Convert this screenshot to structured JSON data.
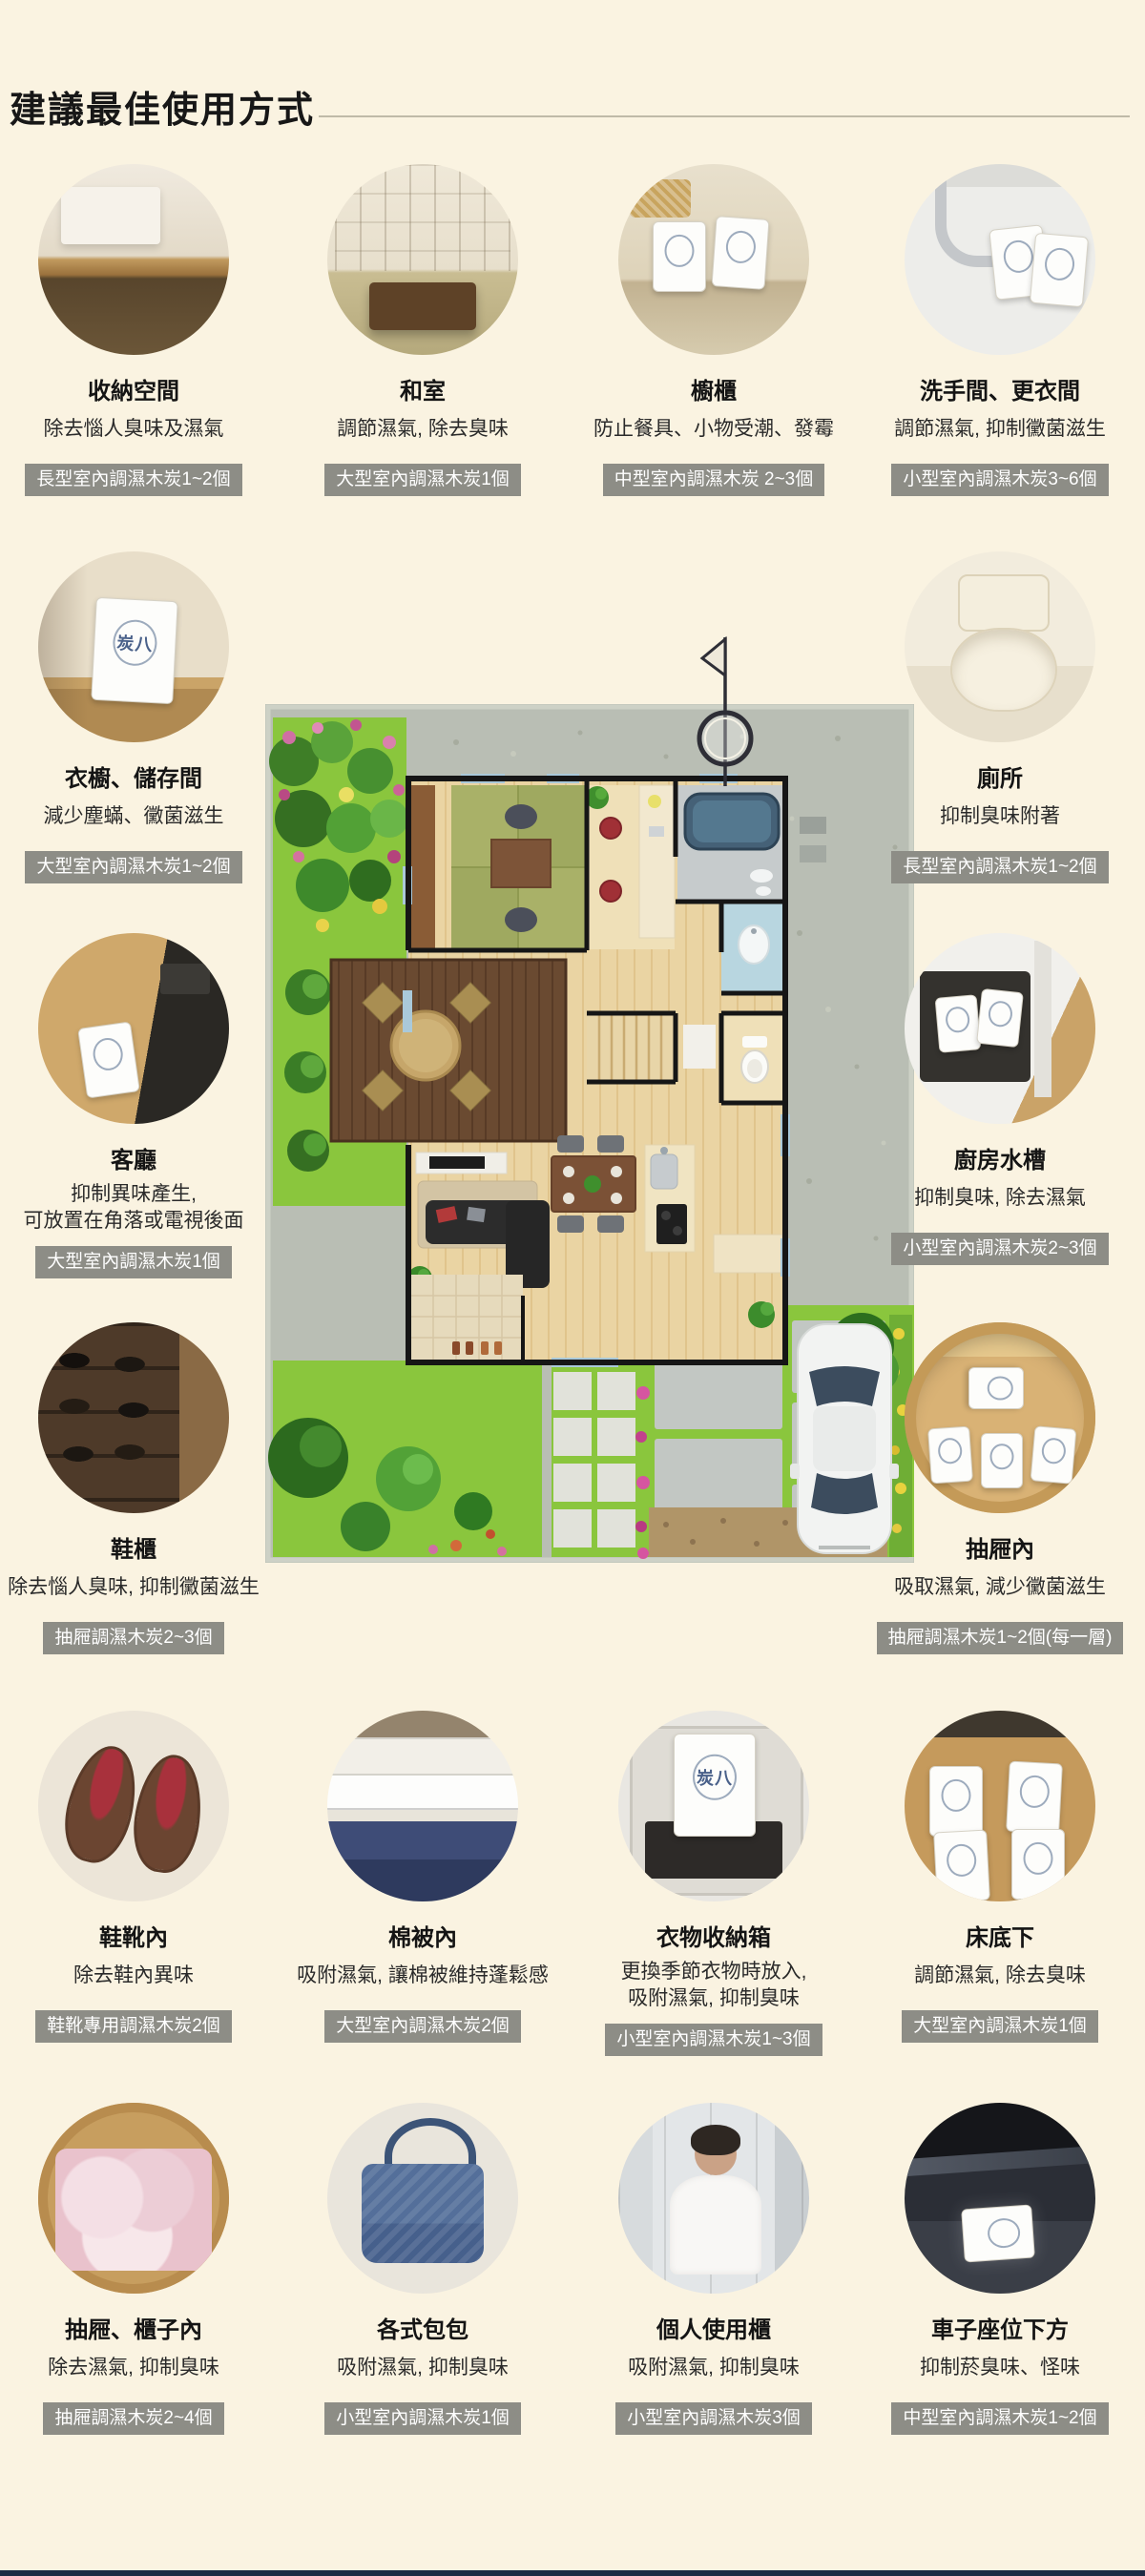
{
  "theme": {
    "background": "#faf3e1",
    "badge_bg": "#8d8d86",
    "badge_text": "#ffffff",
    "bottom_bar": "#1d2944"
  },
  "header": {
    "title": "建議最佳使用方式"
  },
  "bag_label": "炭八",
  "items": [
    {
      "title": "收納空間",
      "desc": "除去惱人臭味及濕氣",
      "badge": "長型室內調濕木炭1~2個"
    },
    {
      "title": "和室",
      "desc": "調節濕氣, 除去臭味",
      "badge": "大型室內調濕木炭1個"
    },
    {
      "title": "櫥櫃",
      "desc": "防止餐具、小物受潮、發霉",
      "badge": "中型室內調濕木炭 2~3個"
    },
    {
      "title": "洗手間、更衣間",
      "desc": "調節濕氣, 抑制黴菌滋生",
      "badge": "小型室內調濕木炭3~6個"
    },
    {
      "title": "衣櫥、儲存間",
      "desc": "減少塵蟎、黴菌滋生",
      "badge": "大型室內調濕木炭1~2個"
    },
    {
      "title": "廁所",
      "desc": "抑制臭味附著",
      "badge": "長型室內調濕木炭1~2個"
    },
    {
      "title": "客廳",
      "desc": "抑制異味產生,\n可放置在角落或電視後面",
      "badge": "大型室內調濕木炭1個"
    },
    {
      "title": "廚房水槽",
      "desc": "抑制臭味, 除去濕氣",
      "badge": "小型室內調濕木炭2~3個"
    },
    {
      "title": "鞋櫃",
      "desc": "除去惱人臭味, 抑制黴菌滋生",
      "badge": "抽屜調濕木炭2~3個"
    },
    {
      "title": "抽屜內",
      "desc": "吸取濕氣, 減少黴菌滋生",
      "badge": "抽屜調濕木炭1~2個(每一層)"
    },
    {
      "title": "鞋靴內",
      "desc": "除去鞋內異味",
      "badge": "鞋靴專用調濕木炭2個"
    },
    {
      "title": "棉被內",
      "desc": "吸附濕氣, 讓棉被維持蓬鬆感",
      "badge": "大型室內調濕木炭2個"
    },
    {
      "title": "衣物收納箱",
      "desc": "更換季節衣物時放入,\n吸附濕氣, 抑制臭味",
      "badge": "小型室內調濕木炭1~3個"
    },
    {
      "title": "床底下",
      "desc": "調節濕氣, 除去臭味",
      "badge": "大型室內調濕木炭1個"
    },
    {
      "title": "抽屜、櫃子內",
      "desc": "除去濕氣, 抑制臭味",
      "badge": "抽屜調濕木炭2~4個"
    },
    {
      "title": "各式包包",
      "desc": "吸附濕氣, 抑制臭味",
      "badge": "小型室內調濕木炭1個"
    },
    {
      "title": "個人使用櫃",
      "desc": "吸附濕氣, 抑制臭味",
      "badge": "小型室內調濕木炭3個"
    },
    {
      "title": "車子座位下方",
      "desc": "抑制菸臭味、怪味",
      "badge": "中型室內調濕木炭1~2個"
    }
  ]
}
